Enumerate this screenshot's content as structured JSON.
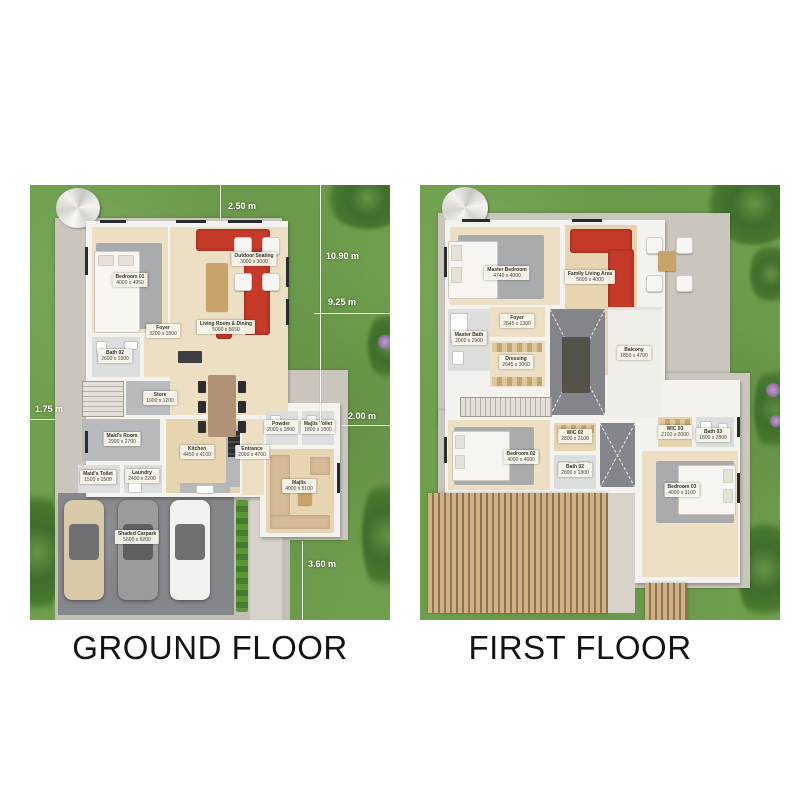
{
  "colors": {
    "background": "#ffffff",
    "grass": "#6f9e4d",
    "sofa_accent_red": "#c63a2a",
    "plot_concrete": "#cac6be",
    "title_text": "#141414",
    "dimension_text": "#ffffff"
  },
  "ground_floor": {
    "title": "GROUND FLOOR",
    "dimensions": [
      {
        "label": "2.50 m"
      },
      {
        "label": "10.90 m"
      },
      {
        "label": "9.25 m"
      },
      {
        "label": "2.00 m"
      },
      {
        "label": "1.75 m"
      },
      {
        "label": "3.60 m"
      }
    ],
    "rooms": [
      {
        "name": "Bedroom 01",
        "size": "4000 x 4950"
      },
      {
        "name": "Bath 02",
        "size": "2600 x 1900"
      },
      {
        "name": "Foyer",
        "size": "3200 x 1800"
      },
      {
        "name": "Living Room & Dining",
        "size": "5000 x 5650"
      },
      {
        "name": "Outdoor Seating",
        "size": "3000 x 3000"
      },
      {
        "name": "Store",
        "size": "1900 x 1200"
      },
      {
        "name": "Maid's Room",
        "size": "2900 x 2700"
      },
      {
        "name": "Maid's Toilet",
        "size": "1500 x 1500"
      },
      {
        "name": "Laundry",
        "size": "2400 x 2200"
      },
      {
        "name": "Kitchen",
        "size": "4450 x 4100"
      },
      {
        "name": "Entrance",
        "size": "2000 x 4700"
      },
      {
        "name": "Powder",
        "size": "2000 x 1800"
      },
      {
        "name": "Majlis Toilet",
        "size": "1800 x 1800"
      },
      {
        "name": "Majlis",
        "size": "4000 x 5100"
      },
      {
        "name": "Shaded Carpark",
        "size": "5600 x 6200"
      }
    ]
  },
  "first_floor": {
    "title": "FIRST FLOOR",
    "rooms": [
      {
        "name": "Master Bedroom",
        "size": "4740 x 4000"
      },
      {
        "name": "Family Living Area",
        "size": "5600 x 4000"
      },
      {
        "name": "Foyer",
        "size": "2645 x 1300"
      },
      {
        "name": "Master Bath",
        "size": "2000 x 2900"
      },
      {
        "name": "Dressing",
        "size": "2645 x 3060"
      },
      {
        "name": "Balcony",
        "size": "1850 x 4700"
      },
      {
        "name": "Bedroom 02",
        "size": "4000 x 4600"
      },
      {
        "name": "WIC 02",
        "size": "2800 x 2100"
      },
      {
        "name": "Bath 02",
        "size": "2800 x 1800"
      },
      {
        "name": "WIC 03",
        "size": "2100 x 2000"
      },
      {
        "name": "Bath 03",
        "size": "1800 x 2800"
      },
      {
        "name": "Bedroom 03",
        "size": "4000 x 3100"
      }
    ]
  }
}
